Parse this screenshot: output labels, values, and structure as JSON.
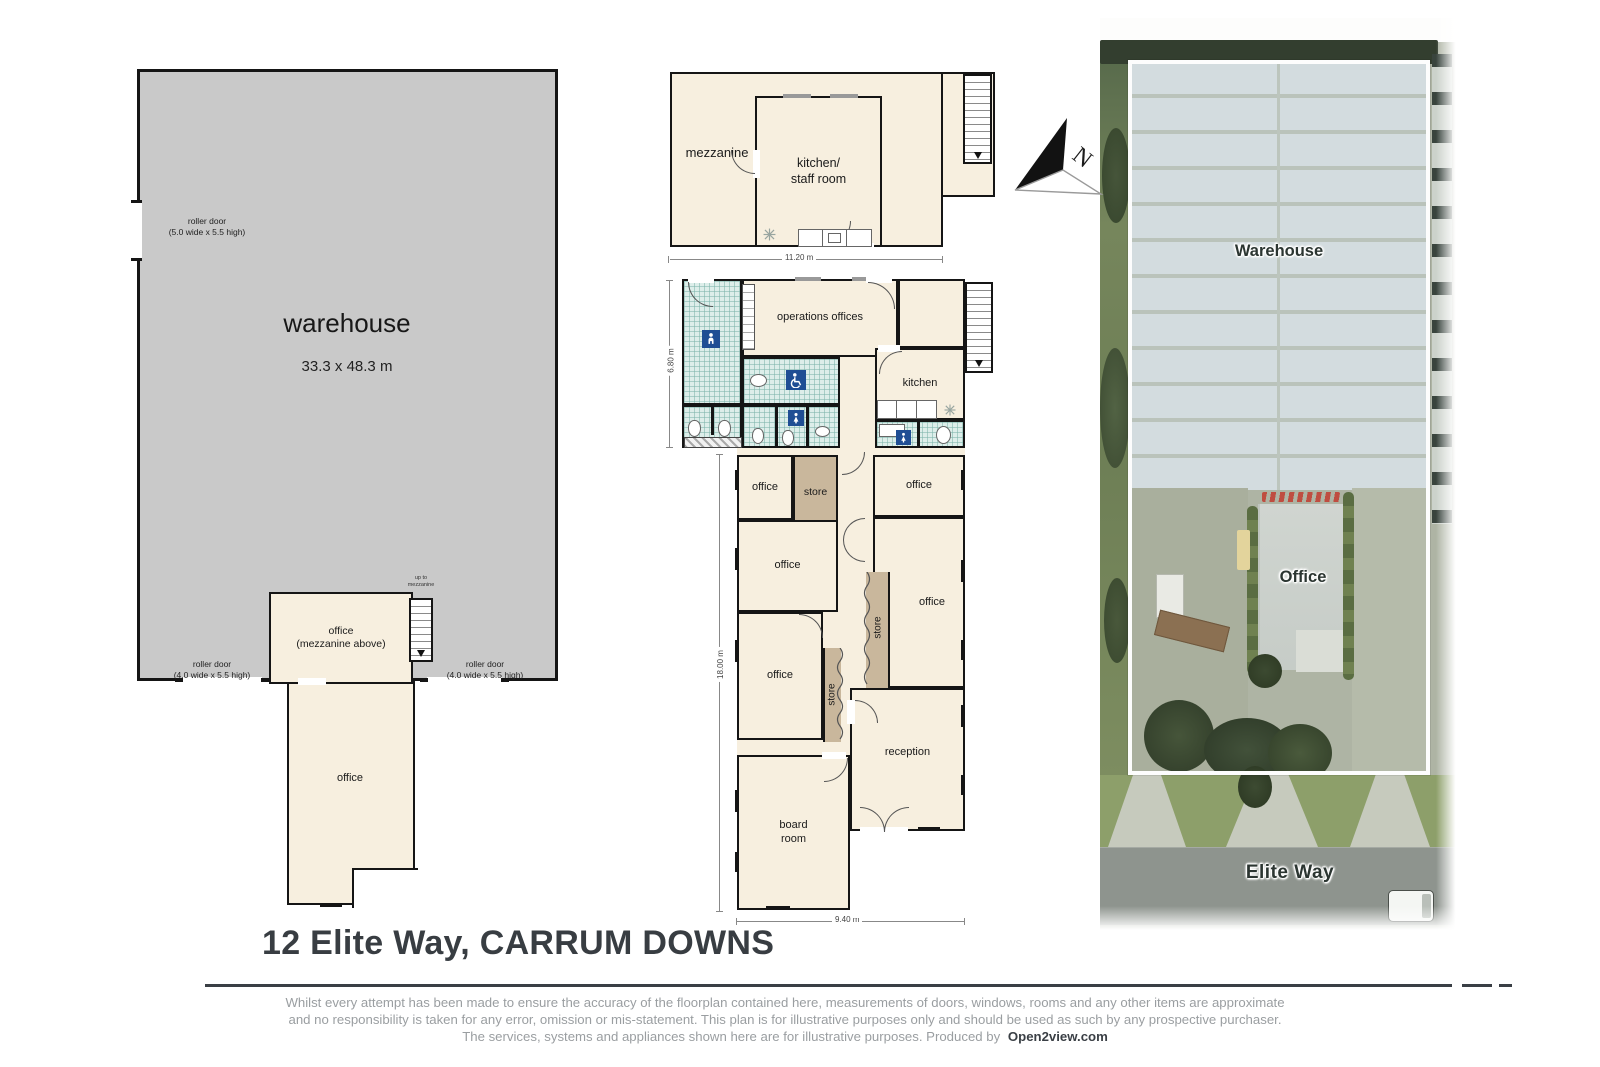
{
  "page": {
    "title_text": "12 Elite Way, CARRUM DOWNS"
  },
  "disclaimer": {
    "line1": "Whilst every attempt has been made to ensure the accuracy of the floorplan contained here, measurements of doors, windows, rooms and any other items are approximate",
    "line2": "and no responsibility is taken for any error, omission or mis-statement.  This plan is for illustrative purposes only and should be used as such by any prospective purchaser.",
    "line3": "The services, systems and appliances shown here are for illustrative purposes.   Produced by",
    "brand": "Open2view.com"
  },
  "warehouse_plan": {
    "room_label": "warehouse",
    "room_dims": "33.3 x 48.3 m",
    "roller_door_side": [
      "roller door",
      "(5.0 wide x 5.5 high)"
    ],
    "roller_door_bottom_left": [
      "roller door",
      "(4.0 wide x 5.5 high)"
    ],
    "roller_door_bottom_right": [
      "roller door",
      "(4.0 wide x 5.5 high)"
    ],
    "office_mezzanine": [
      "office",
      "(mezzanine above)"
    ],
    "stairs_note": [
      "up to",
      "mezzanine"
    ],
    "office_lower": "office"
  },
  "mezzanine_plan": {
    "mezzanine": "mezzanine",
    "kitchen_staff": [
      "kitchen/",
      "staff room"
    ],
    "width_dim": "11.20 m"
  },
  "ground_plan": {
    "operations": "operations offices",
    "kitchen": "kitchen",
    "office": "office",
    "store": "store",
    "reception": "reception",
    "board_room": [
      "board",
      "room"
    ],
    "dim_top_height": "6.80 m",
    "dim_lower_height": "18.00 m",
    "dim_bottom_width": "9.40 m"
  },
  "aerial": {
    "warehouse": "Warehouse",
    "office": "Office",
    "street": "Elite Way"
  },
  "compass": {
    "north": "N"
  }
}
